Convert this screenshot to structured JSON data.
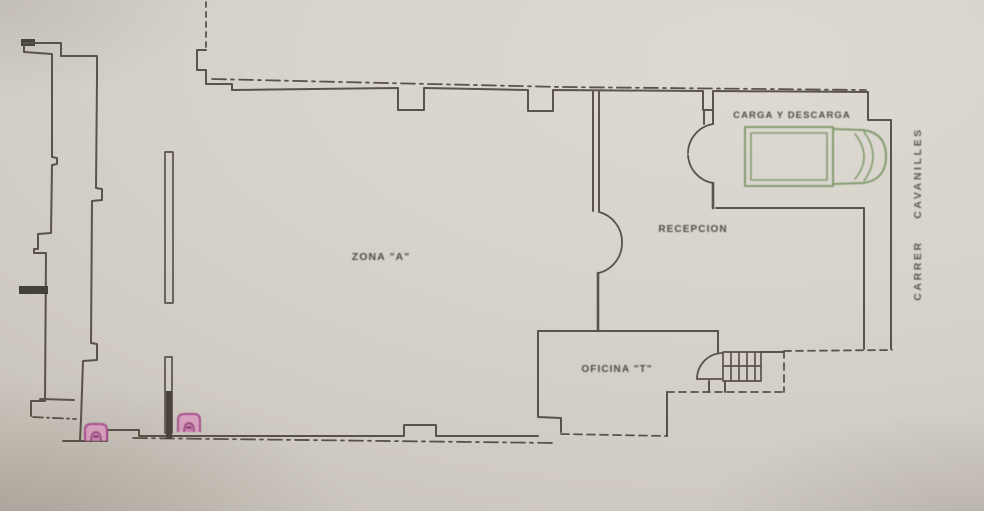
{
  "plan": {
    "labels": {
      "zona_a": "ZONA \"A\"",
      "recepcion": "RECEPCION",
      "carga_descarga": "CARGA Y DESCARGA",
      "oficina": "OFICINA \"T\"",
      "street": "CARRER CAVANILLES"
    },
    "icons": {
      "truck": "truck-icon",
      "stairs": "stairs-icon",
      "double_door": "double-swing-door-icon",
      "single_door": "door-swing-icon",
      "markers": "arch-marker-icon"
    },
    "colors": {
      "paper": "#d6d2ca",
      "ink": "#4d463d",
      "truck_green": "#76925f",
      "marker_pink": "#a5508a"
    }
  }
}
